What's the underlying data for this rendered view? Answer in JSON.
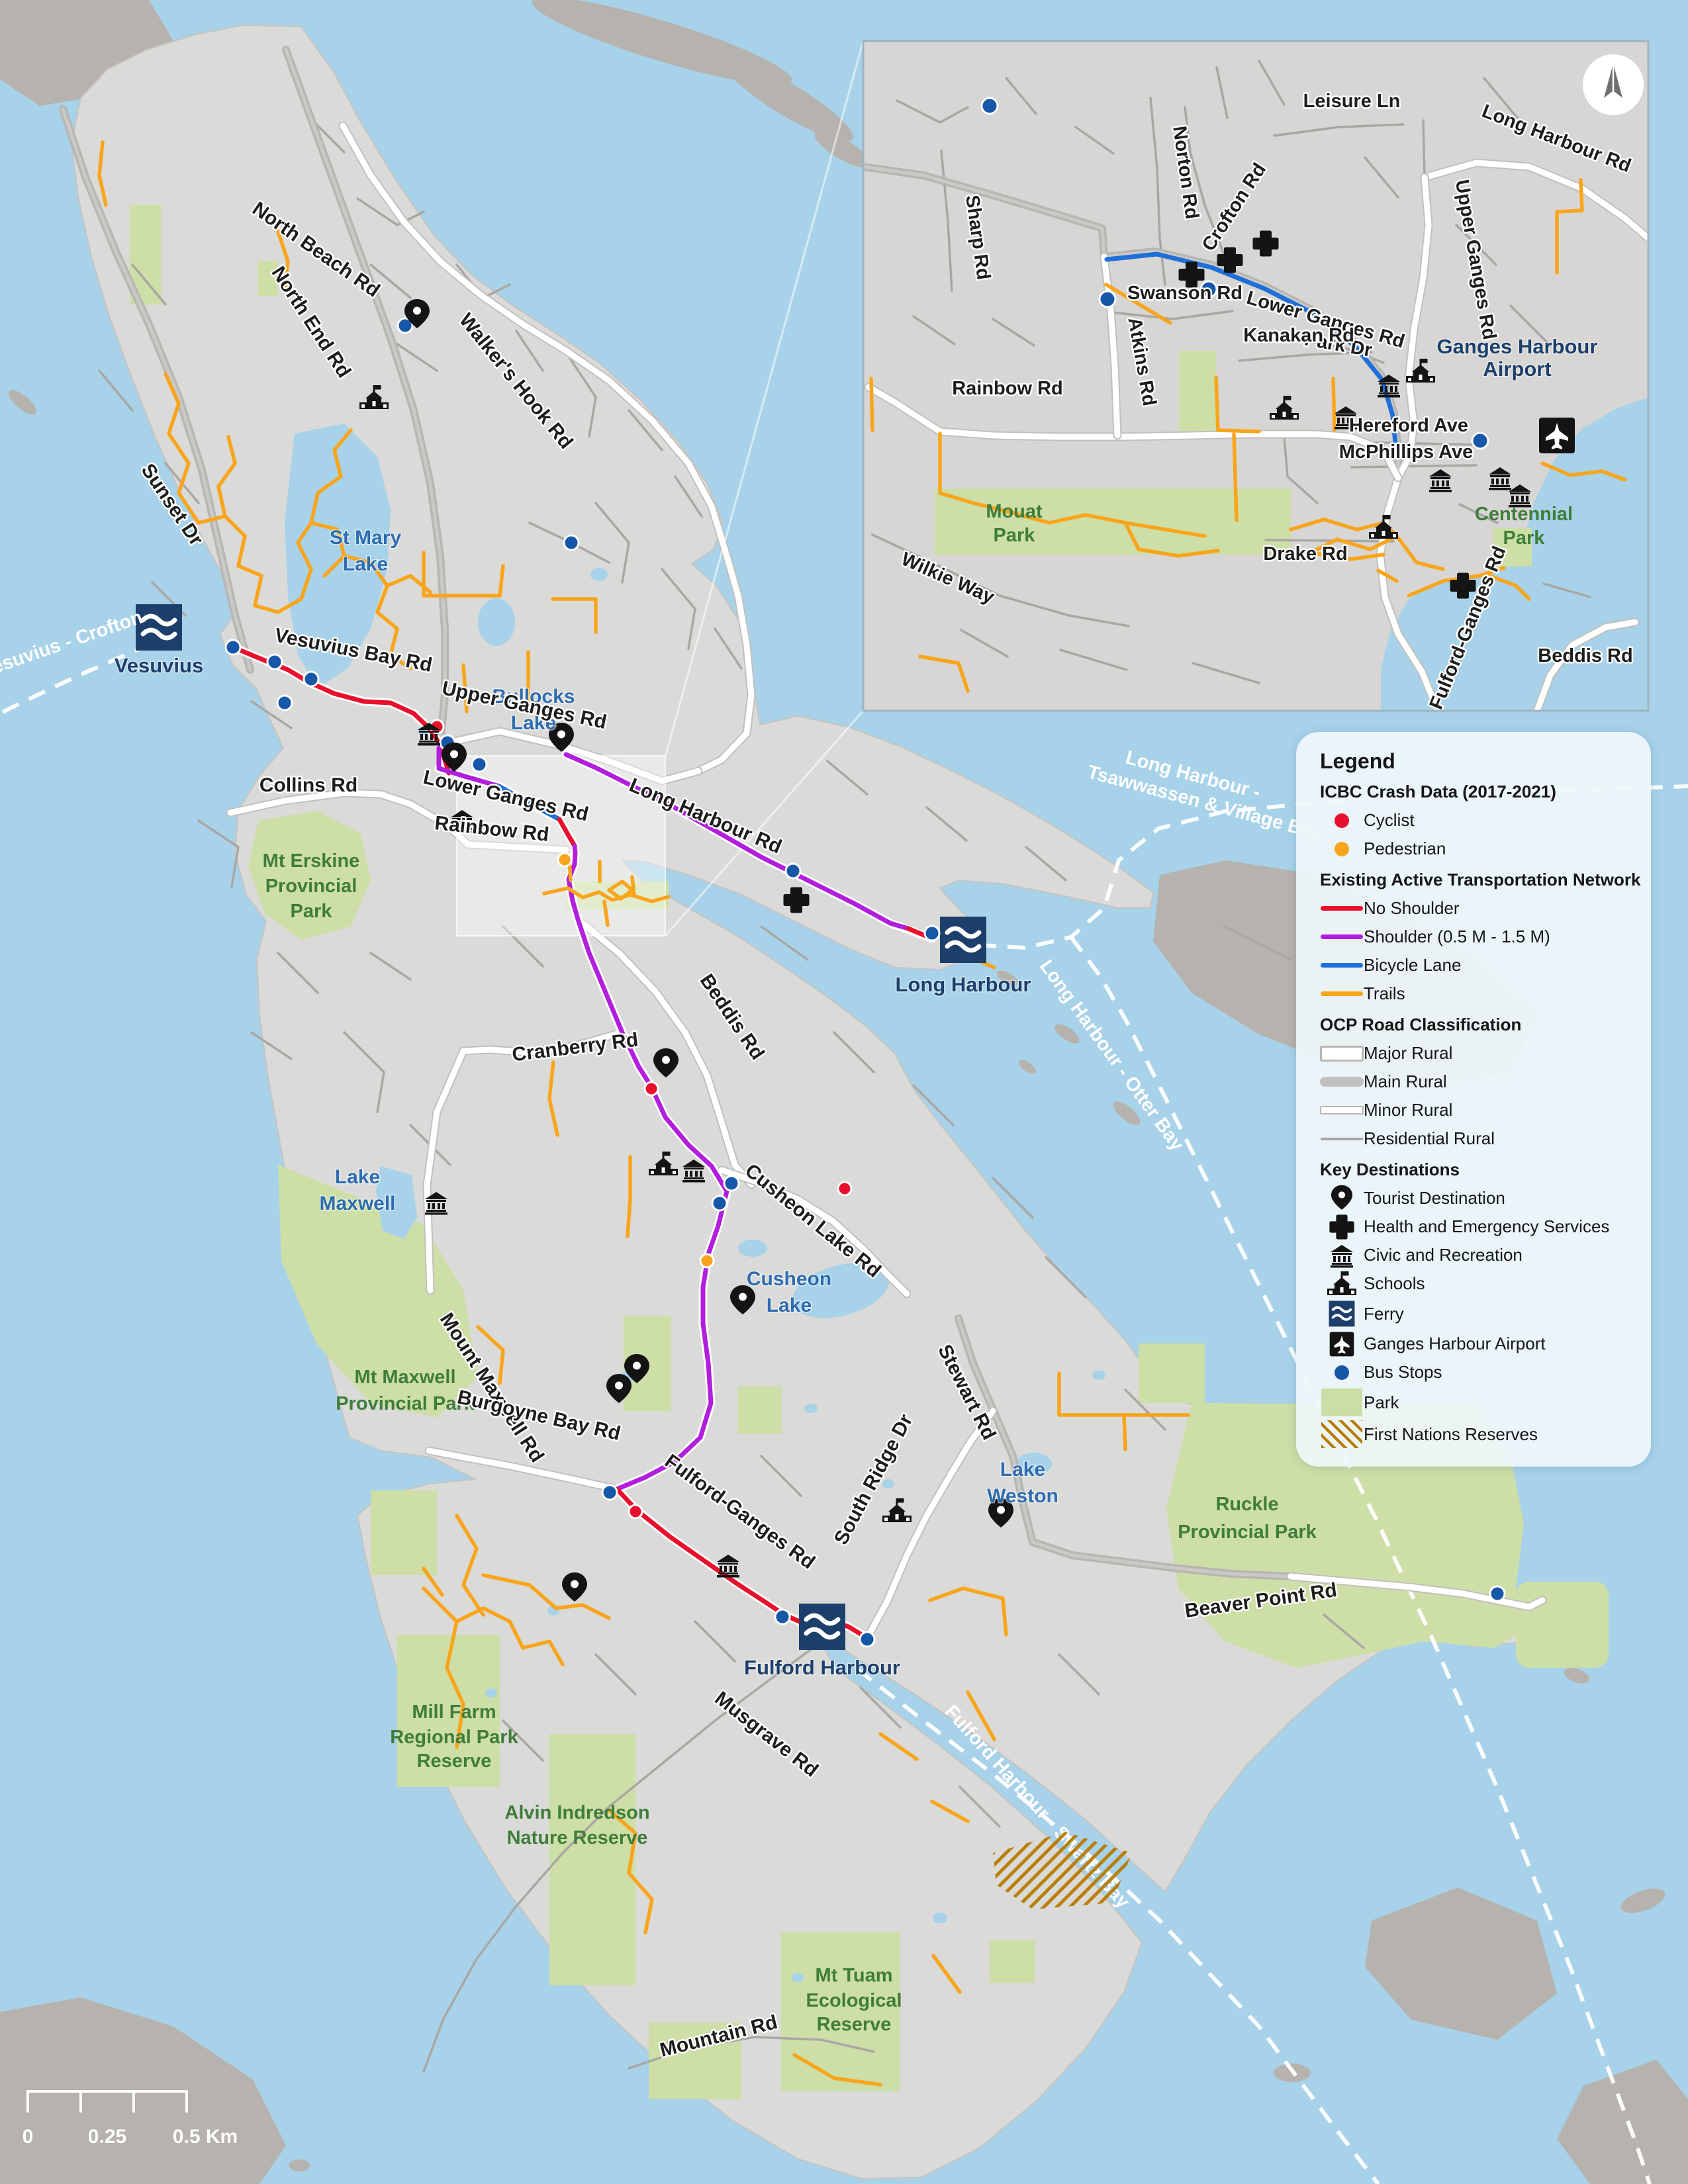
{
  "colors": {
    "water": "#a7d2e9",
    "island": "#dadad8",
    "neighbor_island": "#b6b2ad",
    "park_fill": "#ccdda5",
    "no_shoulder": "#e8112d",
    "shoulder": "#b21edd",
    "bicycle_lane": "#1f6fd9",
    "trails": "#f9a51b",
    "bus_stop": "#1757a8",
    "cyclist": "#e8112d",
    "pedestrian": "#f9a51b",
    "ferry_navy": "#1c3f6b",
    "water_label": "#2e6cb0",
    "park_label": "#3f7d3a",
    "fn_hatch": "#b87a00"
  },
  "legend": {
    "title": "Legend",
    "crash_header": "ICBC Crash Data (2017-2021)",
    "cyclist": "Cyclist",
    "pedestrian": "Pedestrian",
    "network_header": "Existing Active Transportation Network",
    "no_shoulder": "No Shoulder",
    "shoulder": "Shoulder (0.5 M - 1.5 M)",
    "bicycle_lane": "Bicycle Lane",
    "trails": "Trails",
    "ocp_header": "OCP Road Classification",
    "major_rural": "Major Rural",
    "main_rural": "Main Rural",
    "minor_rural": "Minor Rural",
    "residential_rural": "Residential Rural",
    "dest_header": "Key Destinations",
    "tourist": "Tourist Destination",
    "health": "Health and Emergency Services",
    "civic": "Civic and Recreation",
    "schools": "Schools",
    "ferry": "Ferry",
    "airport": "Ganges Harbour Airport",
    "bus_stops": "Bus Stops",
    "park": "Park",
    "first_nations": "First Nations Reserves"
  },
  "scalebar": {
    "zero": "0",
    "quarter": "0.25",
    "half": "0.5 Km"
  },
  "map": {
    "labels": {
      "north_beach_rd": "North Beach Rd",
      "north_end_rd": "North End Rd",
      "walkers_hook_rd": "Walker's Hook Rd",
      "sunset_dr": "Sunset Dr",
      "st_mary_1": "St Mary",
      "st_mary_2": "Lake",
      "bullocks_1": "Bullocks",
      "bullocks_2": "Lake",
      "vesuvius_crofton": "Vesuvius - Crofton",
      "vesuvius": "Vesuvius",
      "vesuvius_bay_rd": "Vesuvius Bay Rd",
      "upper_ganges_rd": "Upper Ganges Rd",
      "collins_rd": "Collins Rd",
      "lower_ganges_rd": "Lower Ganges Rd",
      "rainbow_rd": "Rainbow Rd",
      "long_harbour_rd": "Long Harbour Rd",
      "long_harbour": "Long Harbour",
      "lh_tsaw_1": "Long Harbour -",
      "lh_tsaw_2": "Tsawwassen & Village Bay",
      "lh_otter": "Long Harbour - Otter Bay",
      "mt_erskine_1": "Mt Erskine",
      "mt_erskine_2": "Provincial",
      "mt_erskine_3": "Park",
      "cranberry_rd": "Cranberry Rd",
      "beddis_rd": "Beddis Rd",
      "lake_maxwell_1": "Lake",
      "lake_maxwell_2": "Maxwell",
      "cusheon_lake_rd": "Cusheon Lake Rd",
      "cusheon_1": "Cusheon",
      "cusheon_2": "Lake",
      "mount_maxwell_rd": "Mount Maxwell Rd",
      "mt_maxwell_1": "Mt Maxwell",
      "mt_maxwell_2": "Provincial Park",
      "burgoyne_bay_rd": "Burgoyne Bay Rd",
      "stewart_rd": "Stewart Rd",
      "south_ridge_dr": "South Ridge Dr",
      "lake_weston_1": "Lake",
      "lake_weston_2": "Weston",
      "fulford_ganges_rd": "Fulford-Ganges Rd",
      "ruckle_1": "Ruckle",
      "ruckle_2": "Provincial Park",
      "beaver_point_rd": "Beaver Point Rd",
      "fulford_harbour": "Fulford Harbour",
      "mill_farm_1": "Mill Farm",
      "mill_farm_2": "Regional Park",
      "mill_farm_3": "Reserve",
      "musgrave_rd": "Musgrave Rd",
      "alvin_1": "Alvin Indredson",
      "alvin_2": "Nature Reserve",
      "fulford_swartz": "Fulford Harbour - Swartz Bay",
      "mt_tuam_1": "Mt Tuam",
      "mt_tuam_2": "Ecological",
      "mt_tuam_3": "Reserve",
      "mountain_rd": "Mountain Rd"
    }
  },
  "inset": {
    "labels": {
      "leisure_ln": "Leisure Ln",
      "long_harbour_rd": "Long Harbour Rd",
      "upper_ganges_rd": "Upper Ganges Rd",
      "norton_rd": "Norton Rd",
      "sharp_rd": "Sharp Rd",
      "crofton_rd": "Crofton Rd",
      "lower_ganges_rd": "Lower Ganges Rd",
      "swanson_rd": "Swanson Rd",
      "park_dr": "Park Dr",
      "atkins_rd": "Atkins Rd",
      "kanakan_rd": "Kanakan Rd",
      "rainbow_rd": "Rainbow Rd",
      "ganges_airport_1": "Ganges Harbour",
      "ganges_airport_2": "Airport",
      "hereford_ave": "Hereford Ave",
      "mcphillips_ave": "McPhillips Ave",
      "mouat_1": "Mouat",
      "mouat_2": "Park",
      "drake_rd": "Drake Rd",
      "centennial_1": "Centennial",
      "centennial_2": "Park",
      "wilkie_way": "Wilkie Way",
      "fulford_ganges_rd": "Fulford-Ganges Rd",
      "beddis_rd": "Beddis Rd"
    }
  }
}
